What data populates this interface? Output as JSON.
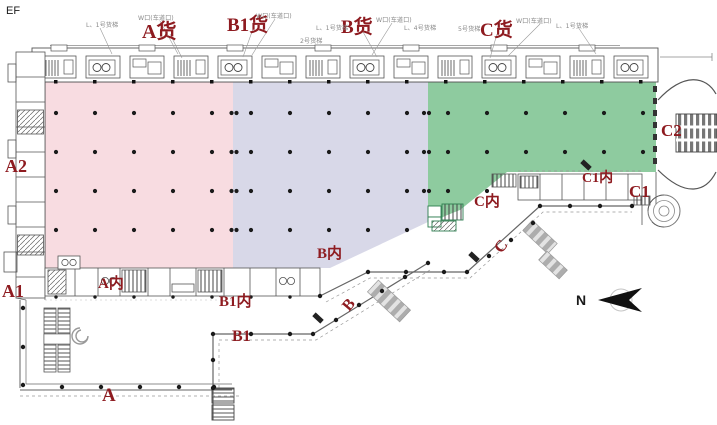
{
  "meta": {
    "corner_label": "EF"
  },
  "colors": {
    "zone_a": "#f8dce1",
    "zone_b": "#d8d8e8",
    "zone_c": "#8ecb9f",
    "label": "#8e1b20",
    "ink": "#1a1a1a"
  },
  "labels": {
    "a_cargo": "A货",
    "b1_cargo": "B1货",
    "b_cargo": "B货",
    "c_cargo": "C货",
    "a2": "A2",
    "a1": "A1",
    "a": "A",
    "a_inner": "A内",
    "b1_inner": "B1内",
    "b_inner": "B内",
    "c_inner": "C内",
    "c1_inner": "C1内",
    "c1": "C1",
    "c2": "C2",
    "b1": "B1",
    "b": "B",
    "c": "C",
    "north": "N"
  },
  "callouts": {
    "k1": "L、1号货梯",
    "k2": "W口(车道口)",
    "k3": "W口(车道口)",
    "k4": "L、1号货梯",
    "k5": "2号货梯",
    "k6": "W口(车道口)",
    "k7": "L、4号货梯",
    "k8": "5号货梯",
    "k9": "W口(车道口)",
    "k10": "L、1号货梯"
  }
}
